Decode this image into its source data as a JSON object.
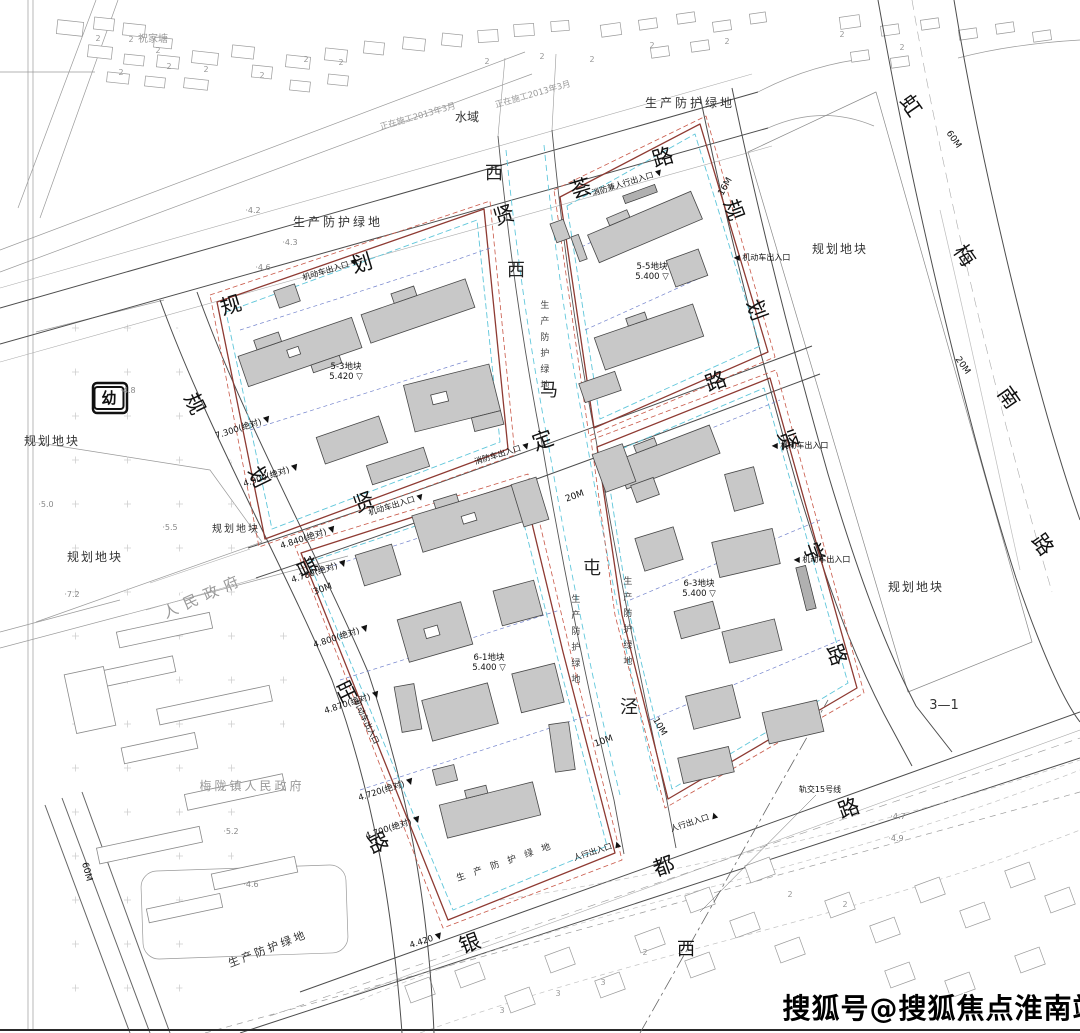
{
  "watermark": "搜狐号@搜狐焦点淮南站",
  "label_groups": {
    "road_xianhui": [
      {
        "t": "规",
        "x": 231,
        "y": 306,
        "s": 21,
        "r": -17,
        "c": "road"
      },
      {
        "t": "划",
        "x": 362,
        "y": 264,
        "s": 21,
        "r": -17,
        "c": "road"
      },
      {
        "t": "贤",
        "x": 504,
        "y": 216,
        "s": 21,
        "r": -17,
        "c": "road"
      },
      {
        "t": "荟",
        "x": 581,
        "y": 189,
        "s": 21,
        "r": -17,
        "c": "road"
      },
      {
        "t": "路",
        "x": 663,
        "y": 158,
        "s": 21,
        "r": -17,
        "c": "road"
      }
    ],
    "road_puwang": [
      {
        "t": "规",
        "x": 194,
        "y": 404,
        "s": 21,
        "r": 64,
        "c": "road"
      },
      {
        "t": "划",
        "x": 258,
        "y": 477,
        "s": 21,
        "r": 64,
        "c": "road"
      },
      {
        "t": "普",
        "x": 306,
        "y": 567,
        "s": 21,
        "r": 64,
        "c": "road"
      },
      {
        "t": "旺",
        "x": 345,
        "y": 692,
        "s": 21,
        "r": 64,
        "c": "road"
      },
      {
        "t": "路",
        "x": 377,
        "y": 843,
        "s": 21,
        "r": 64,
        "c": "road"
      }
    ],
    "road_xianding": [
      {
        "t": "贤",
        "x": 364,
        "y": 503,
        "s": 21,
        "r": -20,
        "c": "road"
      },
      {
        "t": "定",
        "x": 543,
        "y": 441,
        "s": 21,
        "r": -20,
        "c": "road"
      },
      {
        "t": "路",
        "x": 716,
        "y": 382,
        "s": 21,
        "r": -20,
        "c": "road"
      }
    ],
    "road_xianxue": [
      {
        "t": "规",
        "x": 733,
        "y": 210,
        "s": 21,
        "r": 70,
        "c": "road"
      },
      {
        "t": "划",
        "x": 756,
        "y": 310,
        "s": 21,
        "r": 70,
        "c": "road"
      },
      {
        "t": "贤",
        "x": 787,
        "y": 440,
        "s": 21,
        "r": 70,
        "c": "road"
      },
      {
        "t": "学",
        "x": 813,
        "y": 553,
        "s": 21,
        "r": 70,
        "c": "road"
      },
      {
        "t": "路",
        "x": 836,
        "y": 655,
        "s": 21,
        "r": 70,
        "c": "road"
      }
    ],
    "road_yindu": [
      {
        "t": "银",
        "x": 470,
        "y": 944,
        "s": 21,
        "r": -20,
        "c": "road"
      },
      {
        "t": "都",
        "x": 664,
        "y": 867,
        "s": 21,
        "r": -20,
        "c": "road"
      },
      {
        "t": "路",
        "x": 849,
        "y": 809,
        "s": 21,
        "r": -20,
        "c": "road"
      },
      {
        "t": "西",
        "x": 686,
        "y": 950,
        "s": 18,
        "r": 0,
        "c": "road"
      }
    ],
    "road_hongmeinan": [
      {
        "t": "虹",
        "x": 910,
        "y": 106,
        "s": 21,
        "r": 55,
        "c": "road"
      },
      {
        "t": "梅",
        "x": 964,
        "y": 256,
        "s": 21,
        "r": 55,
        "c": "road"
      },
      {
        "t": "南",
        "x": 1008,
        "y": 398,
        "s": 21,
        "r": 55,
        "c": "road"
      },
      {
        "t": "路",
        "x": 1042,
        "y": 545,
        "s": 21,
        "r": 55,
        "c": "road"
      }
    ],
    "creek_ximatunjing": [
      {
        "t": "西",
        "x": 494,
        "y": 174,
        "s": 18,
        "c": "creek"
      },
      {
        "t": "西",
        "x": 516,
        "y": 271,
        "s": 18,
        "c": "creek"
      },
      {
        "t": "马",
        "x": 549,
        "y": 391,
        "s": 18,
        "c": "creek"
      },
      {
        "t": "屯",
        "x": 592,
        "y": 569,
        "s": 18,
        "c": "creek"
      },
      {
        "t": "泾",
        "x": 629,
        "y": 708,
        "s": 18,
        "c": "creek"
      }
    ],
    "parcels": [
      {
        "t": "规划地块",
        "x": 52,
        "y": 441,
        "c": "area"
      },
      {
        "t": "规划地块",
        "x": 95,
        "y": 557,
        "c": "area"
      },
      {
        "t": "规划地块",
        "x": 236,
        "y": 530,
        "s": 10,
        "c": "area"
      },
      {
        "t": "规划地块",
        "x": 840,
        "y": 249,
        "c": "area"
      },
      {
        "t": "规划地块",
        "x": 916,
        "y": 587,
        "c": "area"
      },
      {
        "t": "3—1",
        "x": 944,
        "y": 706,
        "s": 13,
        "c": "small"
      },
      {
        "t": "水域",
        "x": 467,
        "y": 117,
        "s": 12,
        "c": "small"
      },
      {
        "t": "祝家塘",
        "x": 153,
        "y": 40,
        "s": 10,
        "c": "grey"
      },
      {
        "t": "梅陇镇人民政府",
        "x": 252,
        "y": 786,
        "s": 12,
        "c": "grey",
        "ls": 3
      },
      {
        "t": "人民政府",
        "x": 204,
        "y": 596,
        "s": 15,
        "r": -24,
        "c": "grey",
        "ls": 7
      }
    ],
    "kindergarten": [
      {
        "t": "幼",
        "x": 109,
        "y": 398,
        "c": "box"
      }
    ],
    "green_belts": [
      {
        "t": "生产防护绿地",
        "x": 338,
        "y": 222,
        "c": "belt"
      },
      {
        "t": "生产防护绿地",
        "x": 690,
        "y": 103,
        "c": "belt"
      },
      {
        "t": "生产防护绿地",
        "x": 268,
        "y": 949,
        "s": 11,
        "r": -21,
        "c": "belt"
      },
      {
        "t": "生产防护绿地",
        "x": 508,
        "y": 862,
        "s": 9,
        "r": -19,
        "c": "belt",
        "ls": 9
      },
      {
        "t": "生产防护绿地",
        "x": 543,
        "y": 348,
        "c": "beltv",
        "v": 1
      },
      {
        "t": "生产防护绿地",
        "x": 574,
        "y": 642,
        "c": "beltv",
        "v": 1
      },
      {
        "t": "生产防护绿地",
        "x": 626,
        "y": 624,
        "c": "beltv",
        "v": 1
      }
    ],
    "construction_notes": [
      {
        "t": "正在施工2013年3月",
        "x": 418,
        "y": 117,
        "s": 8.5,
        "r": -16,
        "c": "grey"
      },
      {
        "t": "正在施工2013年3月",
        "x": 533,
        "y": 95,
        "s": 8.5,
        "r": -16,
        "c": "grey"
      }
    ],
    "dimensions": [
      {
        "t": "16M",
        "x": 726,
        "y": 187,
        "r": -60,
        "c": "dim"
      },
      {
        "t": "20M",
        "x": 575,
        "y": 497,
        "r": -20,
        "c": "dim"
      },
      {
        "t": "30M",
        "x": 323,
        "y": 590,
        "r": -20,
        "c": "dim"
      },
      {
        "t": "10M",
        "x": 604,
        "y": 742,
        "r": -20,
        "c": "dim"
      },
      {
        "t": "10M",
        "x": 659,
        "y": 727,
        "r": 60,
        "c": "dim"
      },
      {
        "t": "60M",
        "x": 953,
        "y": 140,
        "r": 55,
        "c": "dim"
      },
      {
        "t": "20M",
        "x": 962,
        "y": 366,
        "r": 55,
        "c": "dim"
      },
      {
        "t": "60M",
        "x": 86,
        "y": 872,
        "r": 75,
        "c": "dim"
      }
    ],
    "road_elevations": [
      {
        "t": "7.300(绝对) ▼",
        "x": 243,
        "y": 428,
        "r": -18,
        "c": "elev"
      },
      {
        "t": "4.900(绝对) ▼",
        "x": 271,
        "y": 476,
        "r": -18,
        "c": "elev"
      },
      {
        "t": "4.840(绝对) ▼",
        "x": 308,
        "y": 538,
        "r": -18,
        "c": "elev"
      },
      {
        "t": "4.780(绝对) ▼",
        "x": 319,
        "y": 572,
        "r": -18,
        "c": "elev"
      },
      {
        "t": "4.800(绝对) ▼",
        "x": 341,
        "y": 637,
        "r": -18,
        "c": "elev"
      },
      {
        "t": "4.870(绝对) ▼",
        "x": 352,
        "y": 703,
        "r": -18,
        "c": "elev"
      },
      {
        "t": "4.720(绝对) ▼",
        "x": 386,
        "y": 790,
        "r": -18,
        "c": "elev"
      },
      {
        "t": "4.700(绝对) ▼",
        "x": 393,
        "y": 828,
        "r": -18,
        "c": "elev"
      },
      {
        "t": "4.420 ▼",
        "x": 426,
        "y": 941,
        "r": -18,
        "c": "elev"
      }
    ],
    "block_marks": [
      {
        "t": "5-3地块\n5.420 ▽",
        "x": 346,
        "y": 372,
        "c": "elev"
      },
      {
        "t": "5-5地块\n5.400 ▽",
        "x": 652,
        "y": 272,
        "c": "elev"
      },
      {
        "t": "6-1地块\n5.400 ▽",
        "x": 489,
        "y": 663,
        "c": "elev"
      },
      {
        "t": "6-3地块\n5.400 ▽",
        "x": 699,
        "y": 589,
        "c": "elev"
      }
    ],
    "entrances": [
      {
        "t": "机动车出入口 ▼",
        "x": 330,
        "y": 270,
        "r": -17,
        "c": "tiny"
      },
      {
        "t": "机动车出入口 ▼",
        "x": 396,
        "y": 505,
        "r": -17,
        "c": "tiny"
      },
      {
        "t": "◀ 机动车出入口",
        "x": 800,
        "y": 446,
        "c": "tiny"
      },
      {
        "t": "◀ 机动车出入口",
        "x": 822,
        "y": 560,
        "c": "tiny"
      },
      {
        "t": "◀ 机动车出入口",
        "x": 762,
        "y": 258,
        "c": "tiny"
      },
      {
        "t": "消防车出入口 ▼",
        "x": 502,
        "y": 454,
        "r": -17,
        "c": "tiny"
      },
      {
        "t": "消防兼人行出入口 ▼",
        "x": 627,
        "y": 183,
        "r": -17,
        "c": "tiny"
      },
      {
        "t": "人行出入口 ▲",
        "x": 694,
        "y": 822,
        "r": -18,
        "c": "tiny"
      },
      {
        "t": "人行出入口 ▲",
        "x": 597,
        "y": 851,
        "r": -18,
        "c": "tiny"
      },
      {
        "t": "机动车出入口",
        "x": 366,
        "y": 722,
        "r": 64,
        "c": "tiny"
      }
    ],
    "transit": [
      {
        "t": "轨交15号线",
        "x": 820,
        "y": 790,
        "s": 8,
        "c": "tiny"
      }
    ],
    "spot_elevations": [
      {
        "t": "·4.2",
        "x": 253,
        "y": 211,
        "c": "dot"
      },
      {
        "t": "·4.3",
        "x": 290,
        "y": 243,
        "c": "dot"
      },
      {
        "t": "·4.6",
        "x": 263,
        "y": 268,
        "c": "dot"
      },
      {
        "t": "·4.8",
        "x": 128,
        "y": 391,
        "c": "dot"
      },
      {
        "t": "·5.0",
        "x": 46,
        "y": 505,
        "c": "dot"
      },
      {
        "t": "·5.5",
        "x": 170,
        "y": 528,
        "c": "dot"
      },
      {
        "t": "·7.2",
        "x": 72,
        "y": 595,
        "c": "dot"
      },
      {
        "t": "·5.2",
        "x": 231,
        "y": 832,
        "c": "dot"
      },
      {
        "t": "·4.6",
        "x": 251,
        "y": 885,
        "c": "dot"
      },
      {
        "t": "·4.7",
        "x": 898,
        "y": 817,
        "c": "dot"
      },
      {
        "t": "·4.9",
        "x": 896,
        "y": 839,
        "c": "dot"
      }
    ],
    "storey_numbers": [
      {
        "t": "2",
        "x": 98,
        "y": 39,
        "c": "num"
      },
      {
        "t": "2",
        "x": 131,
        "y": 40,
        "c": "num"
      },
      {
        "t": "2",
        "x": 158,
        "y": 51,
        "c": "num"
      },
      {
        "t": "2",
        "x": 121,
        "y": 73,
        "c": "num"
      },
      {
        "t": "2",
        "x": 169,
        "y": 67,
        "c": "num"
      },
      {
        "t": "2",
        "x": 206,
        "y": 70,
        "c": "num"
      },
      {
        "t": "2",
        "x": 306,
        "y": 60,
        "c": "num"
      },
      {
        "t": "2",
        "x": 262,
        "y": 76,
        "c": "num"
      },
      {
        "t": "2",
        "x": 341,
        "y": 63,
        "c": "num"
      },
      {
        "t": "2",
        "x": 487,
        "y": 62,
        "c": "num"
      },
      {
        "t": "2",
        "x": 542,
        "y": 57,
        "c": "num"
      },
      {
        "t": "2",
        "x": 592,
        "y": 60,
        "c": "num"
      },
      {
        "t": "2",
        "x": 652,
        "y": 46,
        "c": "num"
      },
      {
        "t": "2",
        "x": 727,
        "y": 42,
        "c": "num"
      },
      {
        "t": "2",
        "x": 842,
        "y": 35,
        "c": "num"
      },
      {
        "t": "2",
        "x": 902,
        "y": 48,
        "c": "num"
      },
      {
        "t": "2",
        "x": 645,
        "y": 953,
        "c": "num"
      },
      {
        "t": "3",
        "x": 603,
        "y": 983,
        "c": "num"
      },
      {
        "t": "3",
        "x": 558,
        "y": 994,
        "c": "num"
      },
      {
        "t": "3",
        "x": 502,
        "y": 1011,
        "c": "num"
      },
      {
        "t": "2",
        "x": 790,
        "y": 895,
        "c": "num"
      },
      {
        "t": "2",
        "x": 845,
        "y": 905,
        "c": "num"
      }
    ]
  }
}
